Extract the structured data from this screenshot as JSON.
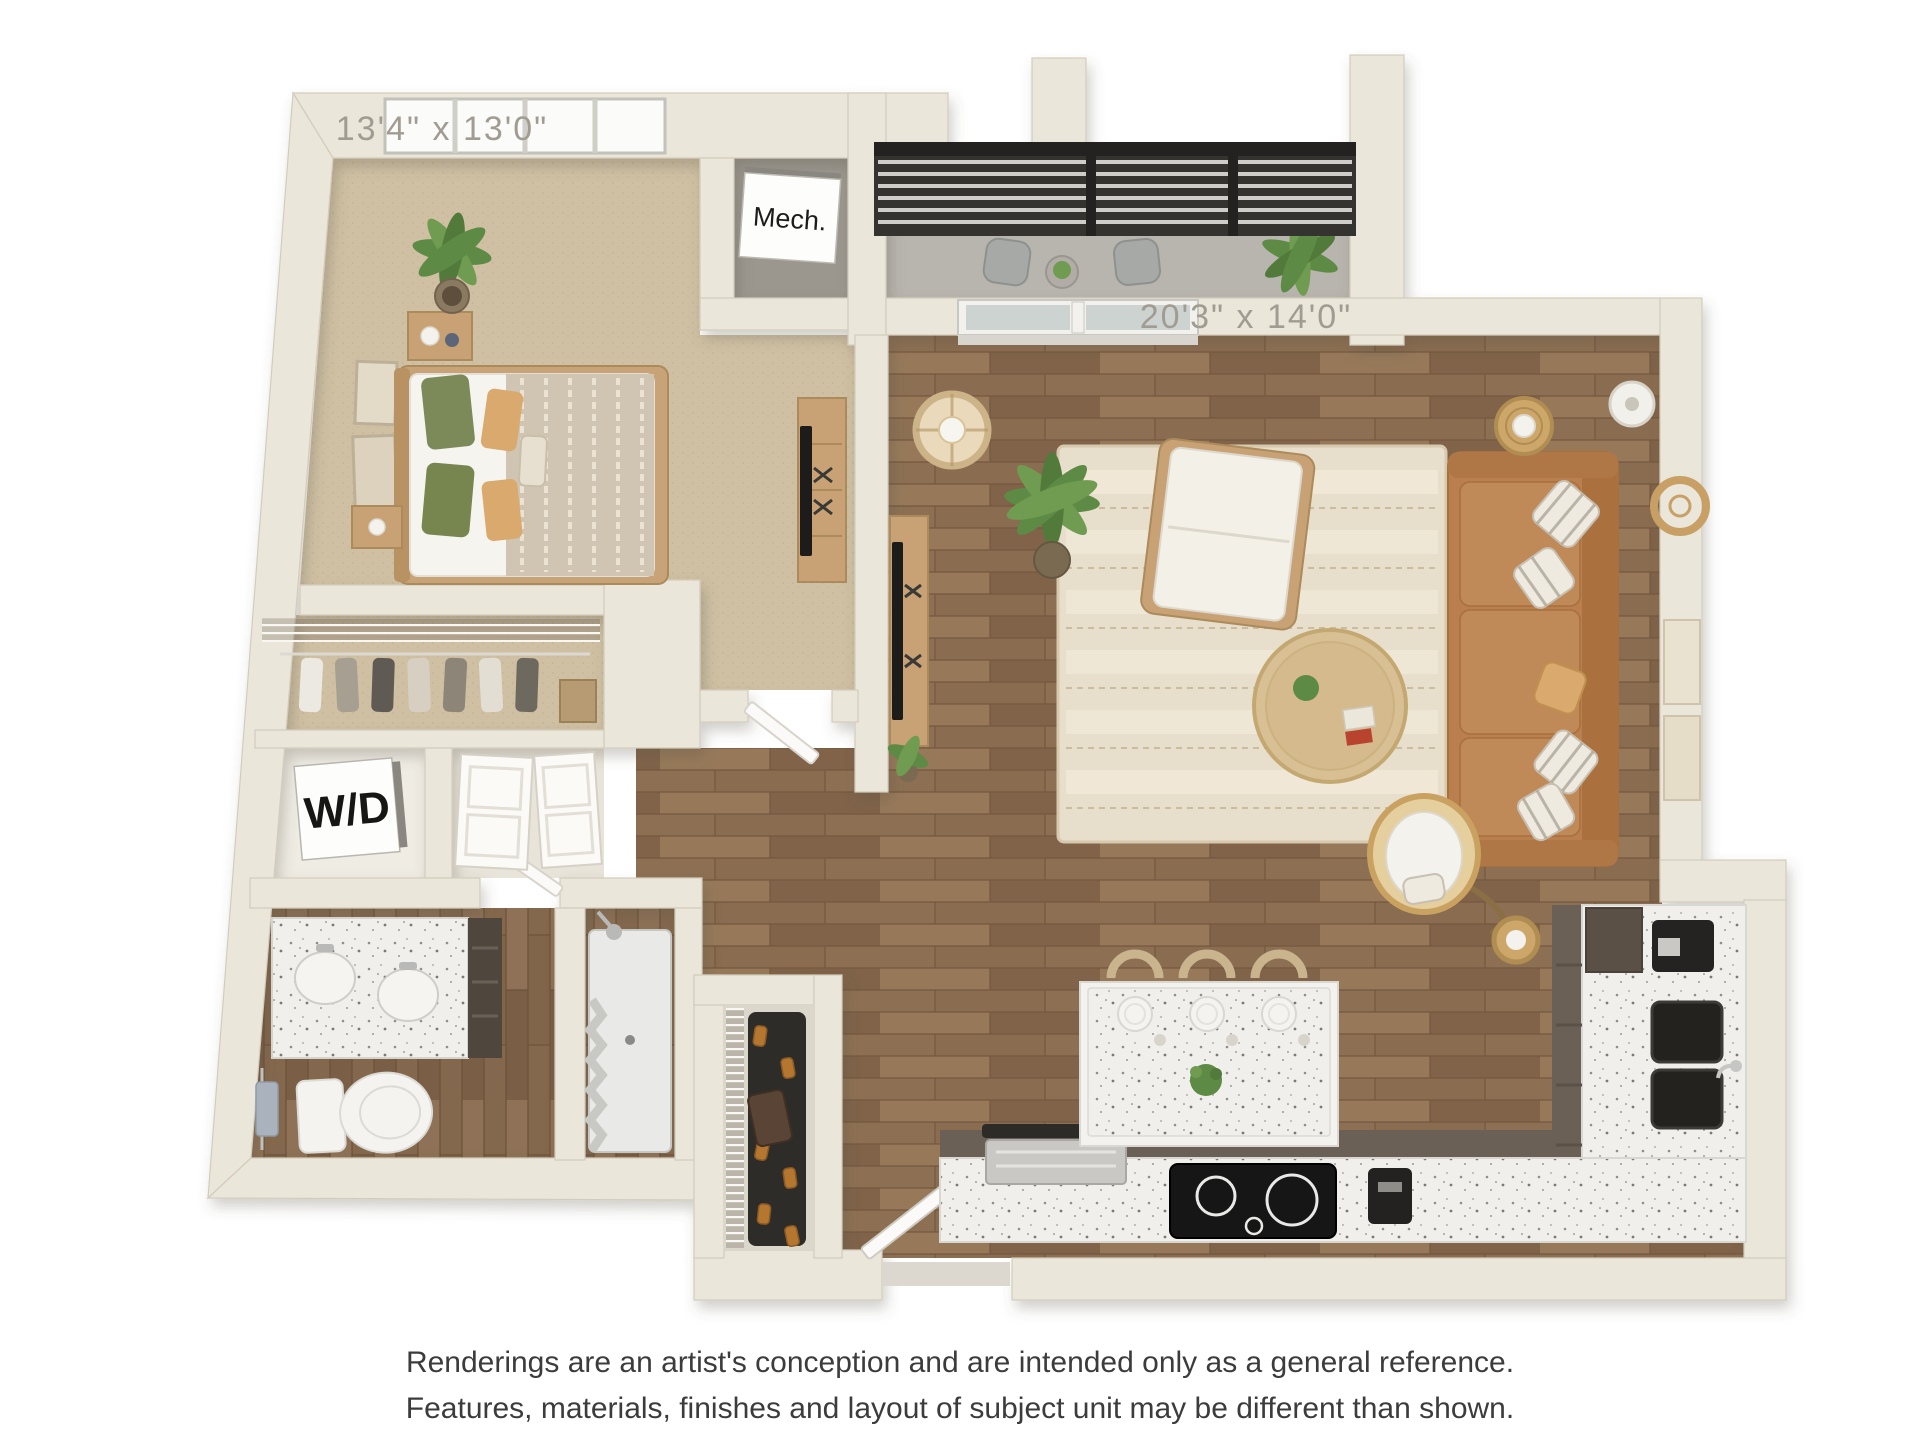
{
  "floor_plan": {
    "labels": {
      "bedroom_dimensions": "13'4\" x 13'0\"",
      "living_dimensions": "20'3\" x 14'0\"",
      "mechanical": "Mech.",
      "washer_dryer": "W/D"
    },
    "colors": {
      "wall": "#ebe6da",
      "wall_outline": "#d3ccbc",
      "carpet": "#cfc0a3",
      "wood": "#8d7053",
      "wood_dark": "#74573f",
      "balcony_floor": "#b8b5ae",
      "railing": "#2f2d29",
      "cabinet": "#6a6055",
      "sofa": "#b97f4e",
      "rug": "#e7decb",
      "plant": "#5d8a45",
      "accent_wood": "#c8a274",
      "glass": "#cdd3d1",
      "label_text": "#a19c92",
      "disclaimer_text": "#3c3c3c"
    }
  },
  "disclaimer": {
    "line1": "Renderings are an artist's conception and are intended only as a general reference.",
    "line2": "Features, materials, finishes and layout of subject unit may be different than shown."
  }
}
